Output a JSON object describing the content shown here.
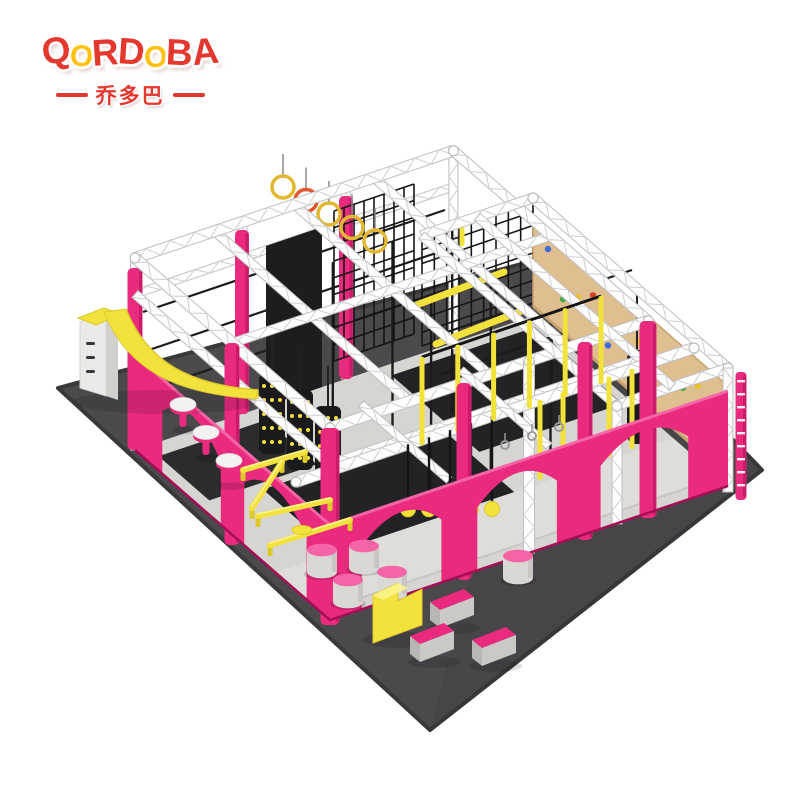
{
  "brand": {
    "logo_letters": [
      {
        "ch": "Q",
        "color": "#E4372E"
      },
      {
        "ch": "O",
        "color": "#FFC10D"
      },
      {
        "ch": "R",
        "color": "#E4372E"
      },
      {
        "ch": "D",
        "color": "#E4372E"
      },
      {
        "ch": "O",
        "color": "#FFC10D"
      },
      {
        "ch": "B",
        "color": "#E4372E"
      },
      {
        "ch": "A",
        "color": "#E4372E"
      }
    ],
    "cjk_name": "乔多巴",
    "cjk_color": "#E4372E"
  },
  "palette": {
    "pink": "#EA2B7D",
    "pinkDark": "#C01263",
    "pinkLight": "#F565A6",
    "pinkSide": "#A50E55",
    "yellow": "#F2E23B",
    "yellowDark": "#DCC92A",
    "yellowHi": "#FBF391",
    "gold": "#E2B832",
    "orange": "#E2572B",
    "truss": "#FEFEFE",
    "trussEdge": "#BEBEBE",
    "trussLat": "#CFCFCF",
    "mat": "#4B494C",
    "matEdge": "#39383B",
    "floor": "#D7D5D1",
    "floorLight": "#DFDDD9",
    "floorSide": "#C8C6C2",
    "black": "#1B1B1D",
    "black2": "#232326",
    "net": "#151515",
    "wood": "#DFBE90",
    "woodEdge": "#C7A272",
    "gray": "#DAD8D5",
    "grayDark": "#B9B7B4",
    "white": "#F3F2F0",
    "holds": [
      "#3F6BD6",
      "#49A847",
      "#E8C32E",
      "#D4452C"
    ]
  },
  "scene": {
    "description": "Isometric product render of an indoor ninja-warrior obstacle course: white truss frame with pink padded columns and arched pink walls, black cargo nets, salmon ladder, wooden rock-climbing wall, gym rings, hanging balls and straps, warped wall, balance beams, mushroom steps, stepping cylinders and foam wedges on a dark grey floor mat.",
    "equipment": [
      "floor-mat",
      "truss-frame",
      "pink-arch-walls",
      "cargo-net",
      "salmon-ladder",
      "climbing-wall",
      "punching-bag",
      "gym-rings",
      "mesh-roller-columns",
      "hanging-balls",
      "hanging-straps",
      "warped-wall",
      "mushroom-steps",
      "balance-beams",
      "stepping-cylinders",
      "step-block",
      "foam-wedges"
    ]
  }
}
